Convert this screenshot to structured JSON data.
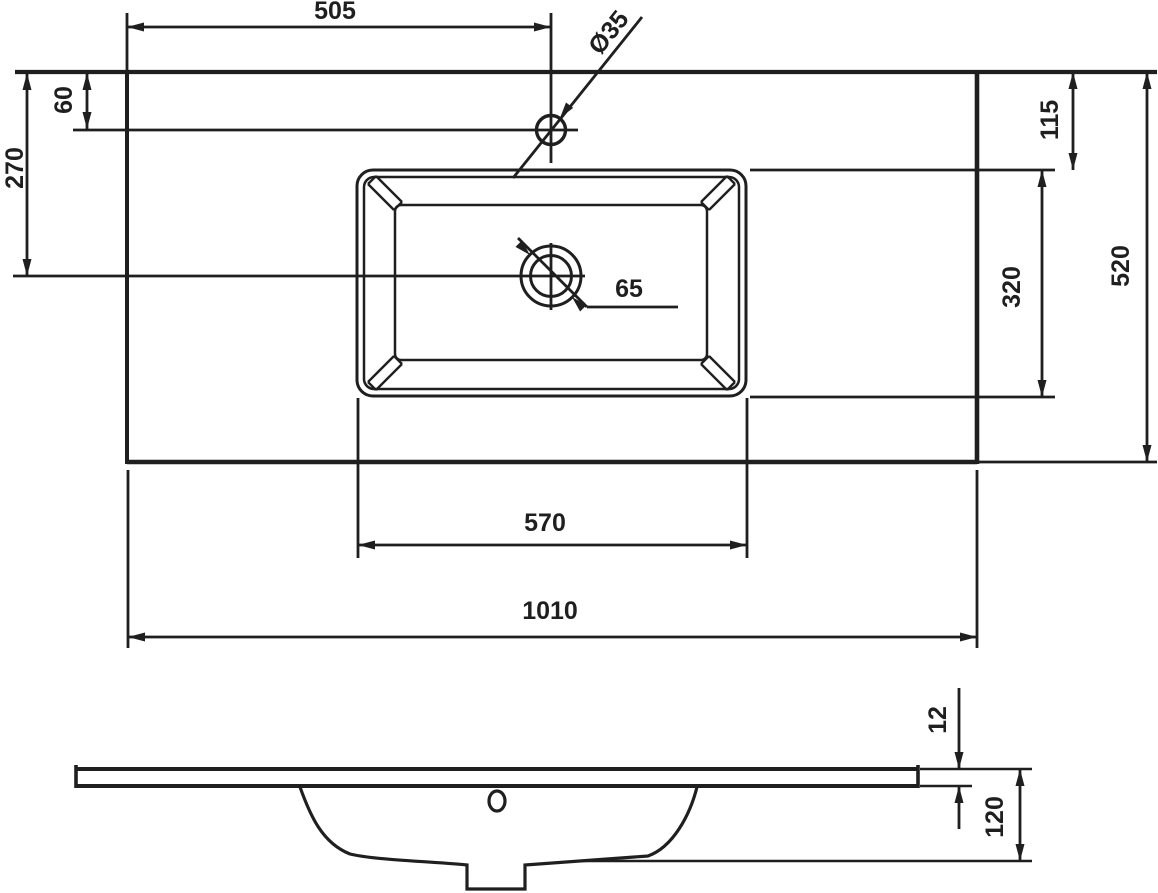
{
  "title": "Washbasin technical dimension drawing",
  "colors": {
    "line": "#1f1f1f",
    "background": "#ffffff"
  },
  "top_view": {
    "name": "plan view of countertop with integrated basin",
    "dimensions": {
      "faucet_offset_x": "505",
      "faucet_hole_diameter": "Ø35",
      "faucet_offset_y": "60",
      "drain_offset_y": "270",
      "top_edge_to_basin": "115",
      "basin_depth_plan": "320",
      "total_depth": "520",
      "drain_diameter": "65",
      "basin_width": "570",
      "total_width": "1010"
    }
  },
  "side_view": {
    "name": "side section view of slab and bowl",
    "dimensions": {
      "slab_thickness": "12",
      "bowl_depth": "120"
    }
  }
}
